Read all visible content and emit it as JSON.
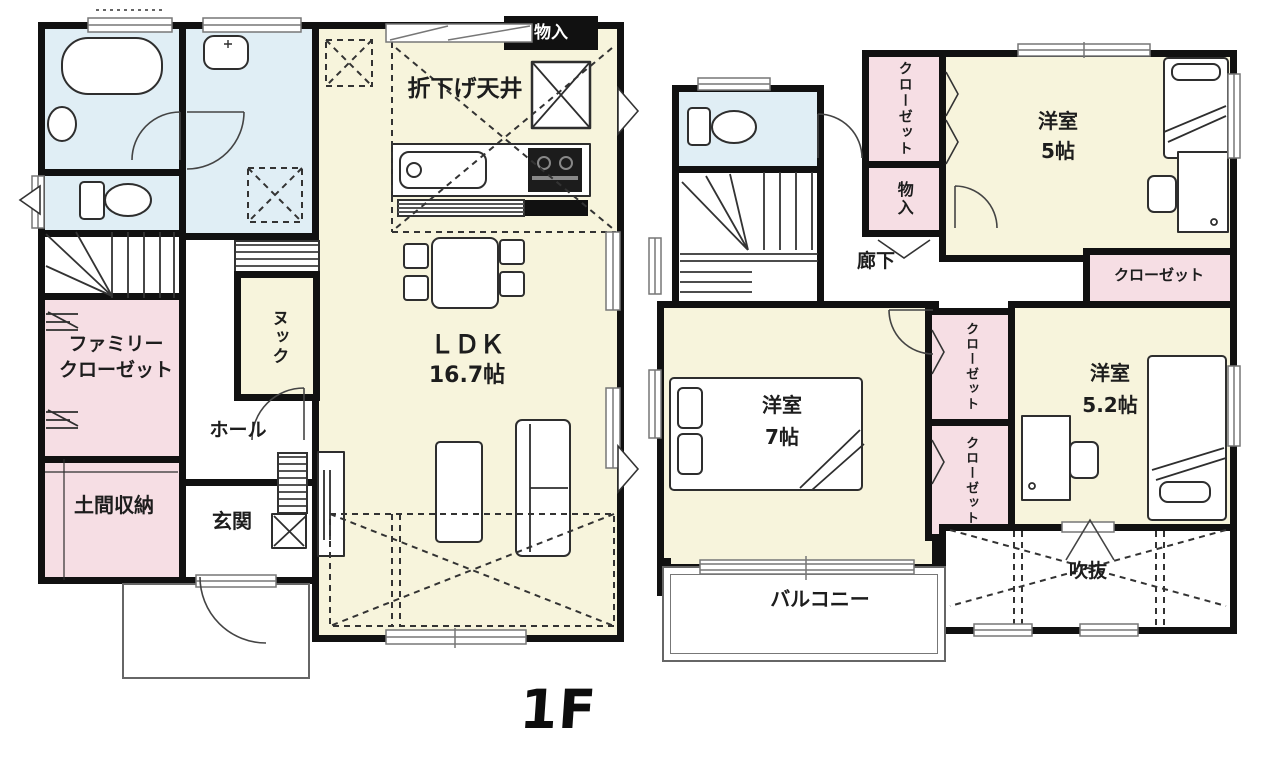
{
  "colors": {
    "wall": "#111111",
    "room_yellow": "#f7f4dc",
    "wet_blue": "#e0eef5",
    "closet_pink": "#f6dee4",
    "line_gray": "#555555"
  },
  "floor1": {
    "floor_label": "1F",
    "rooms": {
      "dropped_ceiling": "折下げ天井",
      "storage": "物入",
      "ldk_name": "ＬＤＫ",
      "ldk_size": "16.7帖",
      "nook": "ヌック",
      "family_closet_l1": "ファミリー",
      "family_closet_l2": "クローゼット",
      "doma_storage": "土間収納",
      "hall": "ホール",
      "entrance": "玄関"
    }
  },
  "floor2": {
    "rooms": {
      "closet_nw_l1": "クロー",
      "closet_nw_l2": "ゼット",
      "storage": "物入",
      "bedroom5_name": "洋室",
      "bedroom5_size": "5帖",
      "closet_east": "クローゼット",
      "corridor": "廊下",
      "bedroom7_name": "洋室",
      "bedroom7_size": "7帖",
      "closet_mid_upper_l1": "クロー",
      "closet_mid_upper_l2": "ゼット",
      "closet_mid_lower_l1": "クロー",
      "closet_mid_lower_l2": "ゼット",
      "bedroom52_name": "洋室",
      "bedroom52_size": "5.2帖",
      "void": "吹抜",
      "balcony": "バルコニー"
    }
  }
}
